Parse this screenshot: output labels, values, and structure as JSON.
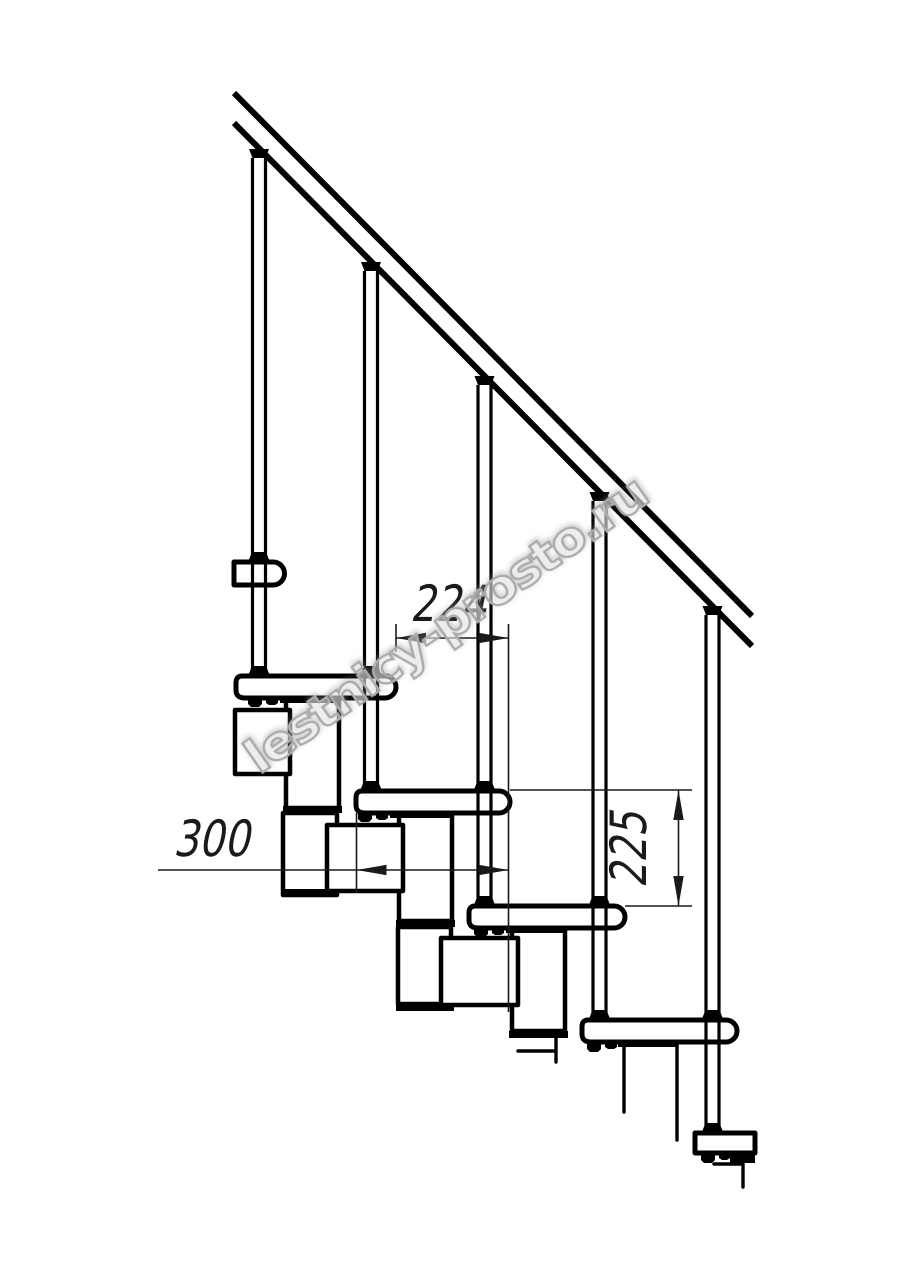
{
  "drawing": {
    "type": "staircase-side-elevation-technical-drawing",
    "background_color": "#ffffff",
    "line_color": "#000000",
    "dimension_color": "#1a1a1a",
    "dimensions": {
      "horizontal_step": "224",
      "tread_depth": "300",
      "riser_height": "225"
    },
    "watermark": {
      "text": "lestnicy-prosto.ru",
      "stroke_color": "#ababab",
      "angle_deg": -35
    },
    "counts": {
      "balusters": 5,
      "treads_visible": 6
    }
  }
}
